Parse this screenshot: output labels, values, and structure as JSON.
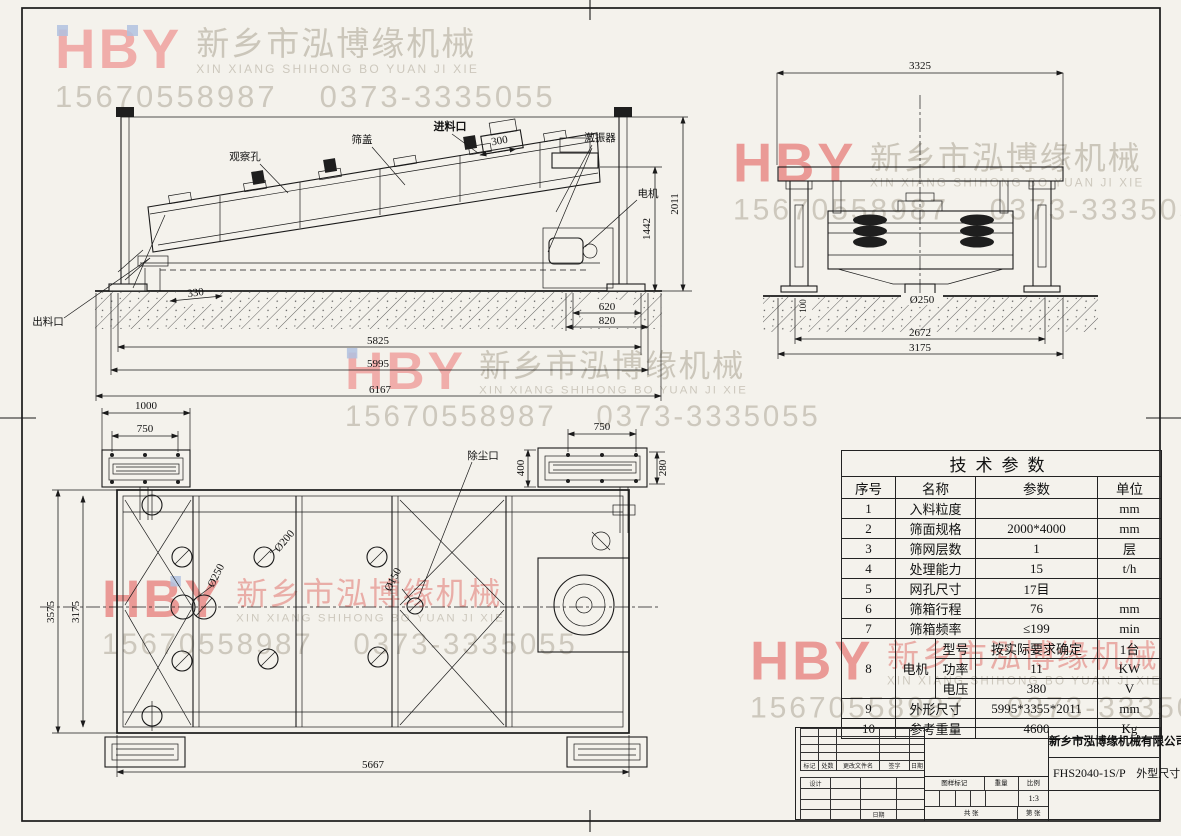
{
  "watermark": {
    "logo": "HBY",
    "company_cn": "新乡市泓博缘机械",
    "company_en": "XIN XIANG SHIHONG BO YUAN JI XIE",
    "phone1": "15670558987",
    "phone2": "0373-3335055"
  },
  "side_view": {
    "labels": {
      "observation_hole": "观察孔",
      "screen_cover": "筛盖",
      "feed_inlet": "进料口",
      "exciter": "激振器",
      "motor": "电机",
      "discharge_outlet": "出料口"
    },
    "dims": {
      "feed_opening": "300",
      "motor_height": "1442",
      "total_height": "2011",
      "discharge": "330",
      "base_inner": "620",
      "base_outer": "820",
      "len_inner": "5825",
      "len_mid": "5995",
      "len_total": "6167"
    }
  },
  "front_view": {
    "dims": {
      "width_top": "3325",
      "outlet_dia": "Ø250",
      "foundation": "100",
      "width_inner": "2672",
      "width_total": "3175"
    }
  },
  "plan_view": {
    "labels": {
      "dust_port": "除尘口"
    },
    "dims": {
      "flange_l": "1000",
      "bolt_l": "750",
      "bolt_r": "750",
      "flange_r_w": "400",
      "flange_r_h": "280",
      "hole_top": "Ø200",
      "hole_mid": "Ø250",
      "hole_small": "Ø150",
      "width_total": "3575",
      "width_inner": "3175",
      "length": "5667"
    }
  },
  "table": {
    "title": "技术参数",
    "headers": [
      "序号",
      "名称",
      "参数",
      "单位"
    ],
    "rows": [
      [
        "1",
        "入料粒度",
        "",
        "mm"
      ],
      [
        "2",
        "筛面规格",
        "2000*4000",
        "mm"
      ],
      [
        "3",
        "筛网层数",
        "1",
        "层"
      ],
      [
        "4",
        "处理能力",
        "15",
        "t/h"
      ],
      [
        "5",
        "网孔尺寸",
        "17目",
        ""
      ],
      [
        "6",
        "筛箱行程",
        "76",
        "mm"
      ],
      [
        "7",
        "筛箱频率",
        "≤199",
        "min"
      ]
    ],
    "motor": {
      "no": "8",
      "name": "电机",
      "rows": [
        [
          "型号",
          "按实际要求确定",
          "1台"
        ],
        [
          "功率",
          "11",
          "KW"
        ],
        [
          "电压",
          "380",
          "V"
        ]
      ]
    },
    "tail": [
      [
        "9",
        "外形尺寸",
        "5995*3355*2011",
        "mm"
      ],
      [
        "10",
        "参考重量",
        "4600",
        "Kg"
      ]
    ]
  },
  "title_block": {
    "company": "新乡市泓博缘机械有限公司",
    "model": "FHS2040-1S/P",
    "title": "外型尺寸",
    "scale": "1:3",
    "labels": {
      "mark": "标记",
      "count": "处数",
      "change_file": "更改文件名",
      "sign": "签字",
      "date": "日期",
      "design": "设计",
      "date2": "日期",
      "drawing_mark": "图样标记",
      "weight": "重量",
      "scale_label": "比例",
      "sheets": "共 张",
      "sheet": "第 张"
    }
  }
}
